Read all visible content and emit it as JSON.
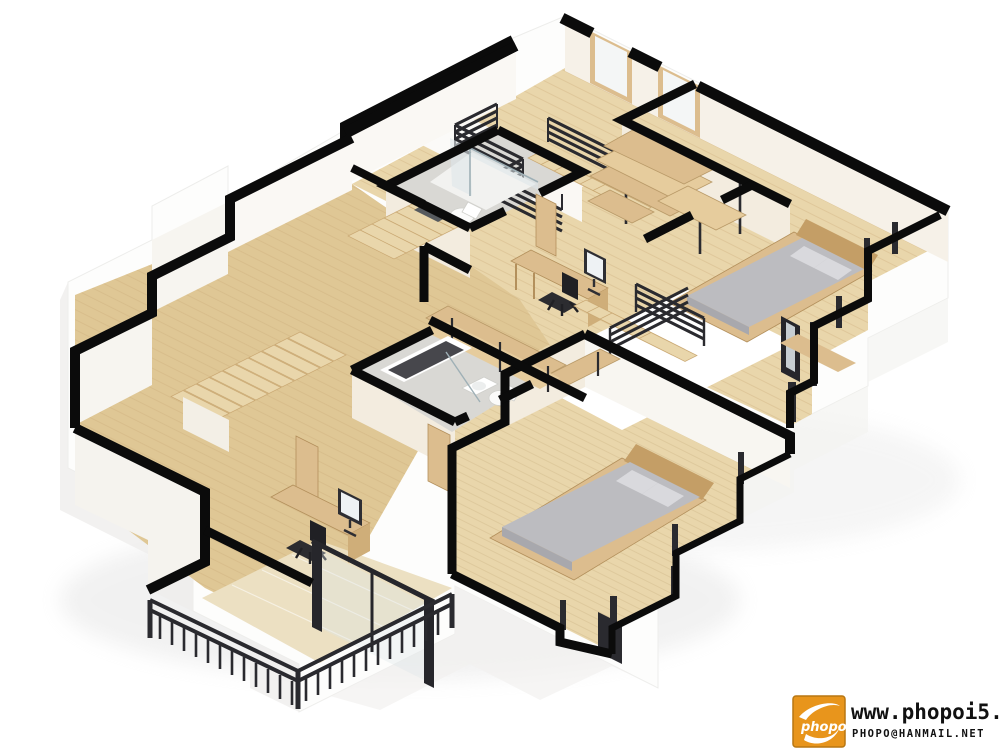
{
  "title": "3D isometric second-floor apartment floor plan render",
  "watermark": {
    "logo_text": "phopo",
    "url": "www.phopoi5.net",
    "email": "PHOPO@HANMAIL.NET"
  },
  "palette": {
    "wall": "#0b0b0b",
    "wood": "#e9d6ab",
    "wood2": "#dfc795",
    "plank": "#c9ab77",
    "fwood": "#dcbd8e",
    "fwood2": "#c49e66",
    "cream": "#f3ecdf",
    "lit": "#faf8f4",
    "rail": "#2a2a2f",
    "bed": "#bcbcc0",
    "bed2": "#a8a8ad",
    "pillow": "#d9d9dd",
    "tile": "#d9d8d4",
    "glass": "#dde6e9",
    "tub": "#47474c",
    "white": "#ffffff",
    "orange": "#e8951c"
  },
  "scene": {
    "style": "cutaway 3D floor plan, 2:1 isometric view, black wall tops, white exterior shell, light wood floors",
    "rooms": [
      {
        "name": "hallway-landing",
        "features": [
          "stairwell opening",
          "dark slatted stair railing",
          "staircase down",
          "two tall windows on north wall",
          "small wood steps to left room"
        ]
      },
      {
        "name": "walk-in-closet",
        "features": [
          "L-shaped open shelving unit with metal posts"
        ]
      },
      {
        "name": "bedroom-right",
        "features": [
          "double bed with gray bedding and wood frame",
          "two pillows",
          "window mullion posts on east wall",
          "terrace door frame"
        ]
      },
      {
        "name": "office-nook",
        "features": [
          "desk with monitor",
          "black office chair",
          "staircase down with dark railing",
          "open void to lower floor"
        ]
      },
      {
        "name": "bathroom-top",
        "features": [
          "glass shower enclosure",
          "toilet",
          "dark bath mat",
          "open wood door"
        ]
      },
      {
        "name": "hall-closet",
        "features": [
          "L-shaped wood shelving counters"
        ]
      },
      {
        "name": "bathroom-lower",
        "features": [
          "bathtub",
          "washbasin",
          "toilet",
          "glass partition",
          "open wood door"
        ]
      },
      {
        "name": "left-room",
        "features": [
          "L-shaped wooden staircase down",
          "open wood door"
        ]
      },
      {
        "name": "bottom-left-room",
        "features": [
          "desk with monitor",
          "black office chair",
          "sliding glass door with dark frame"
        ]
      },
      {
        "name": "balcony-bottom-left",
        "features": [
          "glossy tile floor",
          "dark metal railing with balusters"
        ]
      },
      {
        "name": "bedroom-bottom",
        "features": [
          "double bed with gray bedding and wood frame",
          "two pillows",
          "corner window mullion posts"
        ]
      }
    ]
  }
}
